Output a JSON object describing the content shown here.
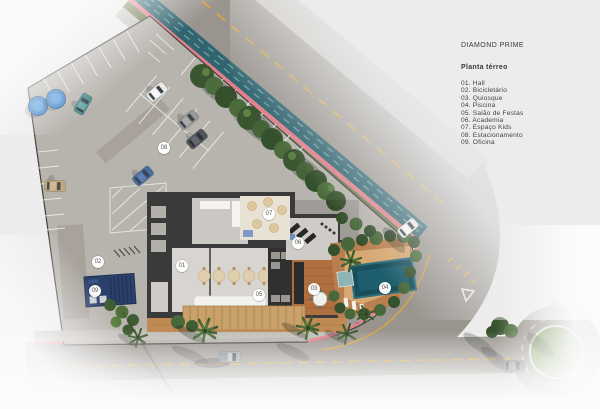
{
  "legend": {
    "project": "DIAMOND PRIME",
    "title": "Planta térreo",
    "items": [
      "01. Hall",
      "02. Bicicletário",
      "03. Quiosque",
      "04. Piscina",
      "05. Salão de Festas",
      "06. Academia",
      "07. Espaço Kids",
      "08. Estacionamento",
      "09. Oficina"
    ]
  },
  "plan": {
    "unit_numbers": [
      "01",
      "02",
      "03",
      "04",
      "05",
      "06",
      "07",
      "08",
      "09"
    ]
  },
  "colors": {
    "background_grey": "#ececec",
    "asphalt": "#99948e",
    "concrete_lot": "#b7b3ad",
    "sidewalk": "#c9c4be",
    "bike_lane_pink": "#e0808c",
    "cycle_path_teal": "#30646f",
    "road_marking_yellow": "#d6a544",
    "roof_dark": "#3a3a3a",
    "deck_wood": "#b9854f",
    "pergola_straw": "#c9a26b",
    "pool_teal": "#174f5c",
    "vegetation_green": "#3a5530",
    "water_tank_blue": "#4488cf",
    "container_blue": "#2b406b"
  }
}
